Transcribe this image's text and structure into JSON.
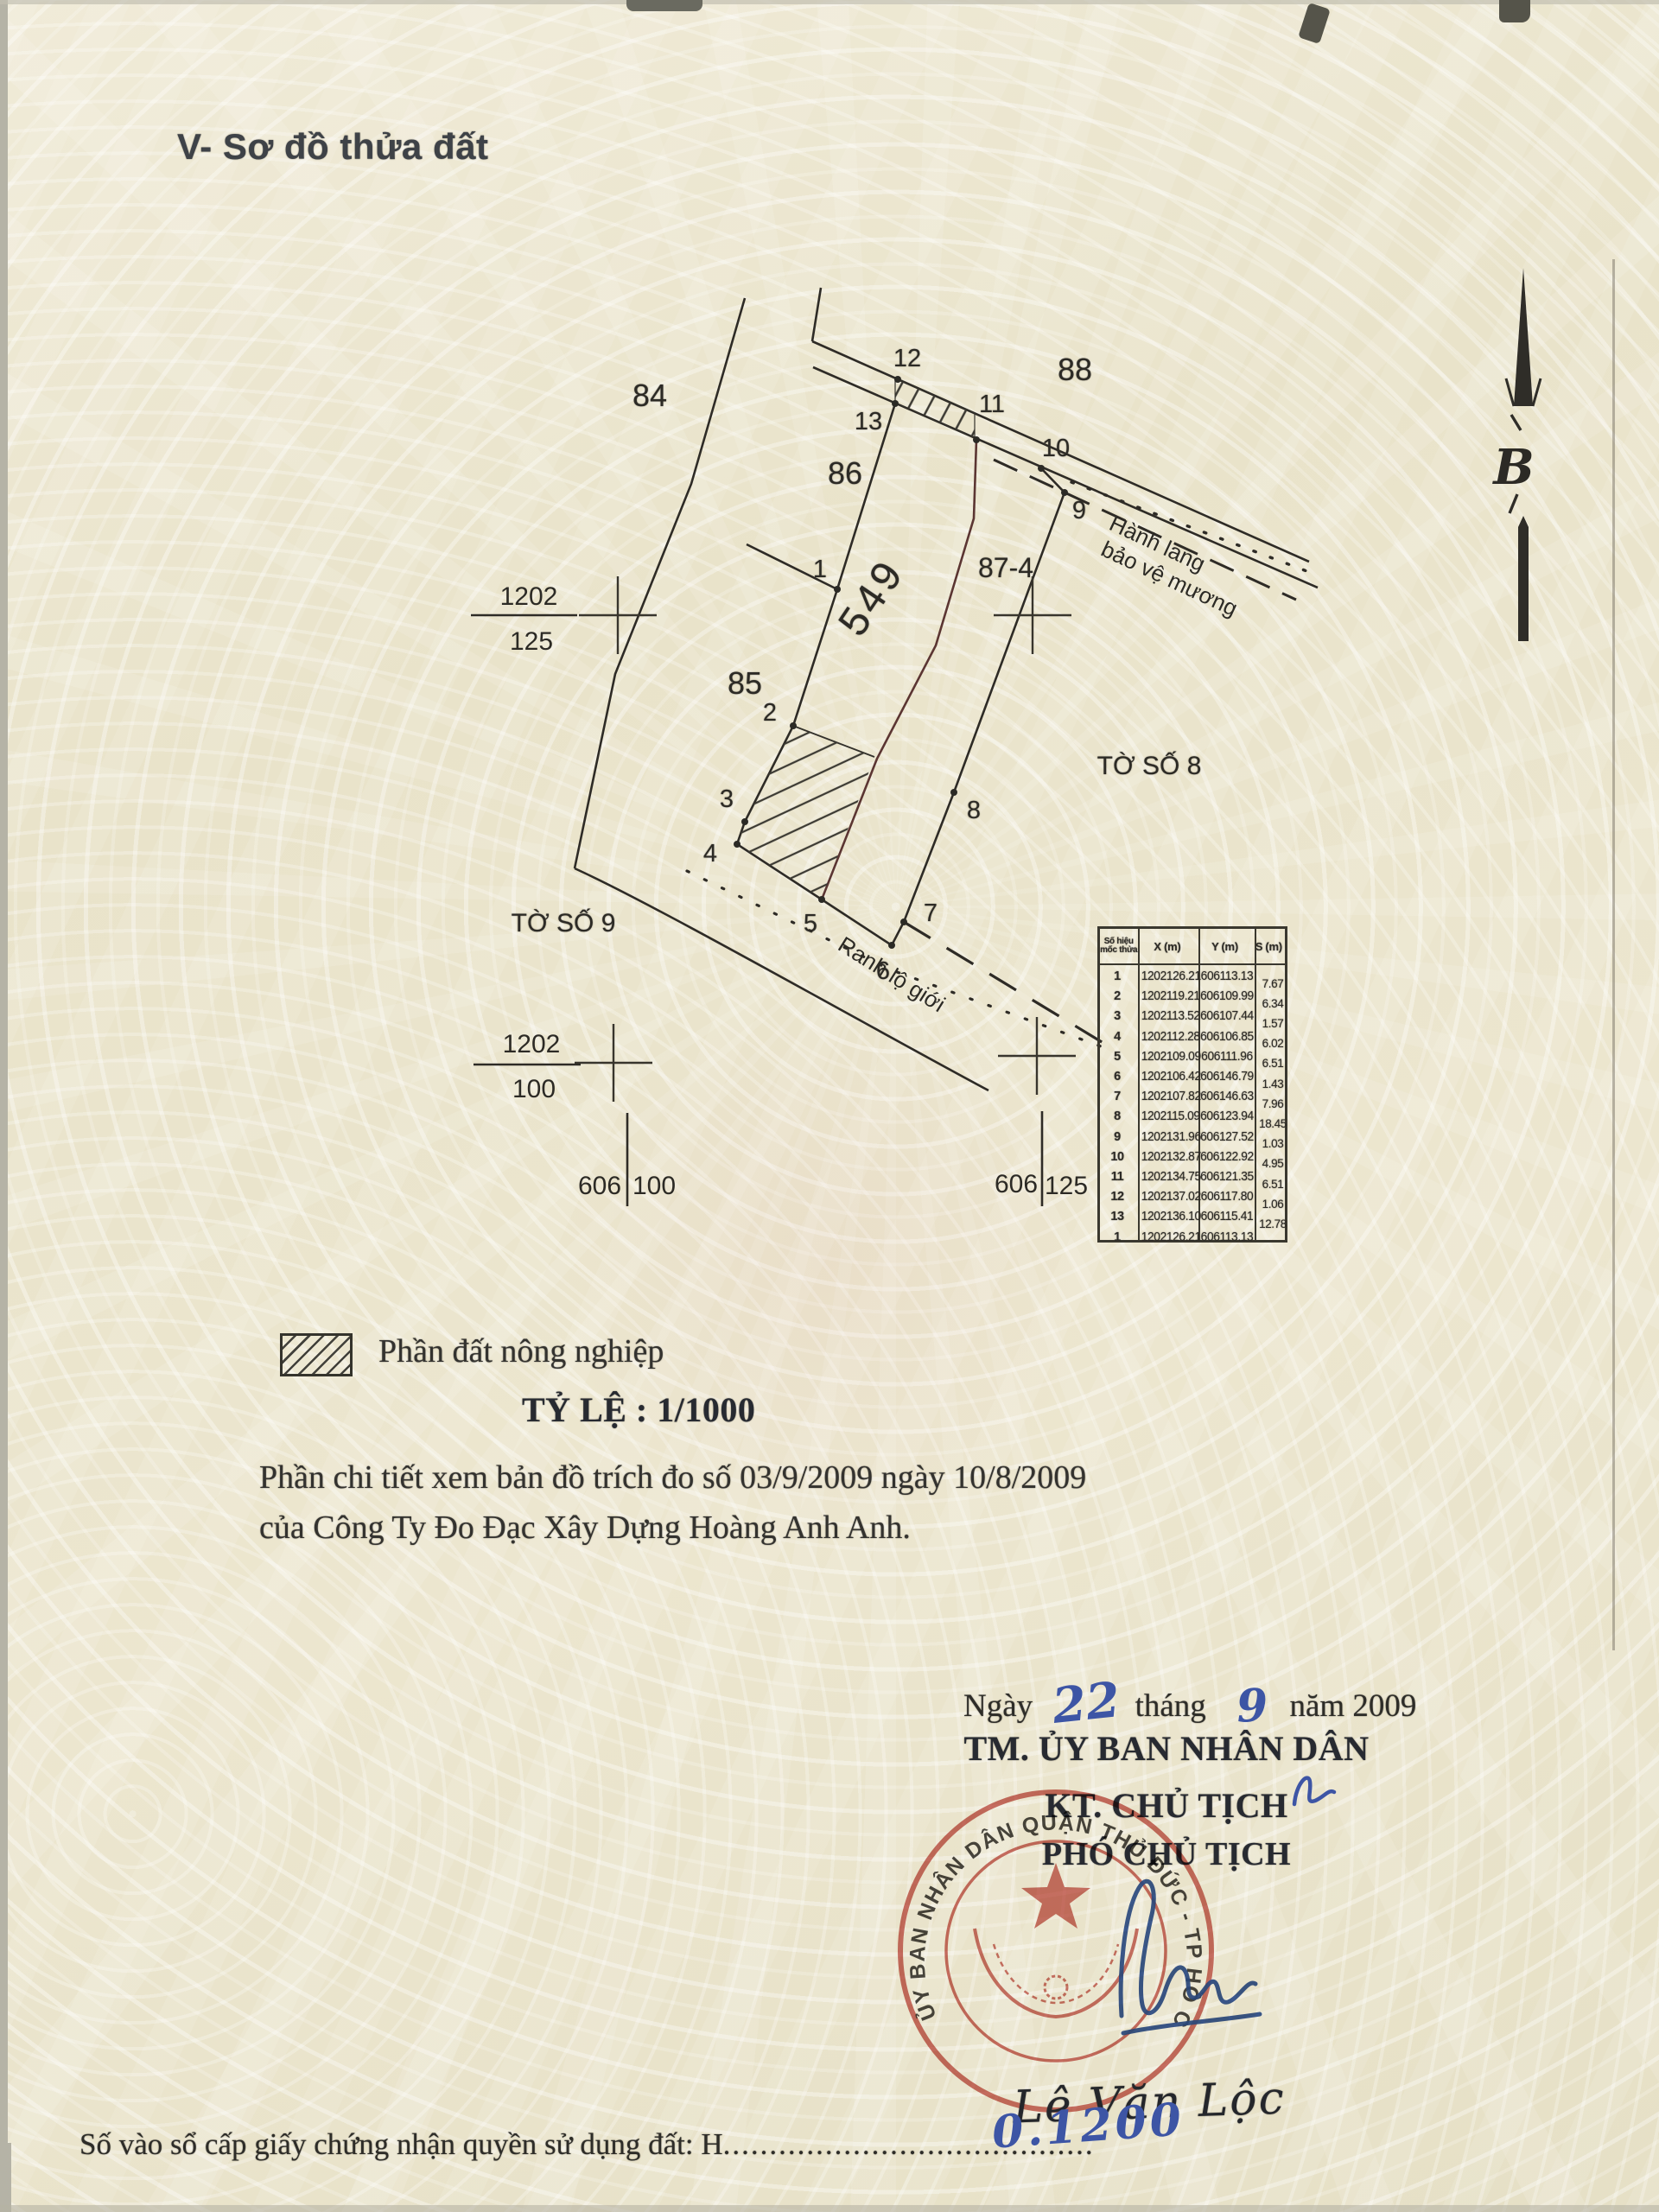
{
  "page": {
    "title": "V- Sơ đồ thửa đất",
    "registry_line": {
      "label": "Số vào sổ cấp giấy chứng nhận quyền sử dụng đất: H",
      "dots": "........................................",
      "number_handwritten": "0.1200"
    }
  },
  "map": {
    "parcel_labels": {
      "p84": "84",
      "p86": "86",
      "p88": "88",
      "p85": "85",
      "p87_4": "87-4",
      "p549": "549"
    },
    "sheet_labels": {
      "sheet8": "TỜ SỐ 8",
      "sheet9": "TỜ SỐ 9"
    },
    "annotations": {
      "corridor_line1": "Hành lang",
      "corridor_line2": "bảo vệ mương",
      "road_boundary": "Ranh lộ giới"
    },
    "grid_fractions": {
      "f1_top": "1202",
      "f1_bottom": "125",
      "f2_top": "1202",
      "f2_bottom": "100"
    },
    "grid_marks": {
      "left_a": "606",
      "left_b": "100",
      "right_a": "606",
      "right_b": "125"
    },
    "point_labels": [
      "1",
      "2",
      "3",
      "4",
      "5",
      "6",
      "7",
      "8",
      "9",
      "10",
      "11",
      "12",
      "13"
    ],
    "north_label": "B"
  },
  "legend": {
    "item_label": "Phần đất nông nghiệp",
    "scale_label": "TỶ LỆ : 1/1000"
  },
  "notes": [
    "Phần chi tiết xem bản đồ trích đo số 03/9/2009 ngày 10/8/2009",
    "của Công Ty Đo Đạc Xây Dựng Hoàng Anh Anh."
  ],
  "signing": {
    "date": {
      "prefix": "Ngày",
      "day": "22",
      "month_label": "tháng",
      "month": "9",
      "year_label": "năm 2009"
    },
    "lines": [
      "TM. ỦY BAN NHÂN DÂN",
      "KT. CHỦ TỊCH",
      "PHÓ CHỦ TỊCH"
    ],
    "signer_name": "Lê Văn Lộc",
    "stamp_text": "ỦY BAN NHÂN DÂN QUẬN THỦ ĐỨC - TP HỒ CHÍ MINH"
  },
  "coordinate_table": {
    "headers": {
      "id": "Số hiệu mốc thửa",
      "x": "X (m)",
      "y": "Y (m)",
      "s": "S (m)"
    },
    "rows": [
      {
        "id": "1",
        "x": "1202126.21",
        "y": "606113.13"
      },
      {
        "id": "2",
        "x": "1202119.21",
        "y": "606109.99"
      },
      {
        "id": "3",
        "x": "1202113.52",
        "y": "606107.44"
      },
      {
        "id": "4",
        "x": "1202112.28",
        "y": "606106.85"
      },
      {
        "id": "5",
        "x": "1202109.09",
        "y": "606111.96"
      },
      {
        "id": "6",
        "x": "1202106.42",
        "y": "606146.79"
      },
      {
        "id": "7",
        "x": "1202107.82",
        "y": "606146.63"
      },
      {
        "id": "8",
        "x": "1202115.09",
        "y": "606123.94"
      },
      {
        "id": "9",
        "x": "1202131.96",
        "y": "606127.52"
      },
      {
        "id": "10",
        "x": "1202132.87",
        "y": "606122.92"
      },
      {
        "id": "11",
        "x": "1202134.75",
        "y": "606121.35"
      },
      {
        "id": "12",
        "x": "1202137.02",
        "y": "606117.80"
      },
      {
        "id": "13",
        "x": "1202136.10",
        "y": "606115.41"
      },
      {
        "id": "1",
        "x": "1202126.21",
        "y": "606113.13"
      }
    ],
    "s_values": [
      "7.67",
      "6.34",
      "1.57",
      "6.02",
      "6.51",
      "1.43",
      "7.96",
      "18.45",
      "1.03",
      "4.95",
      "6.51",
      "1.06",
      "12.78"
    ]
  },
  "colors": {
    "ink": "#2e2b26",
    "stamp_red": "#c4544a",
    "pen_blue": "#3d55a5"
  }
}
